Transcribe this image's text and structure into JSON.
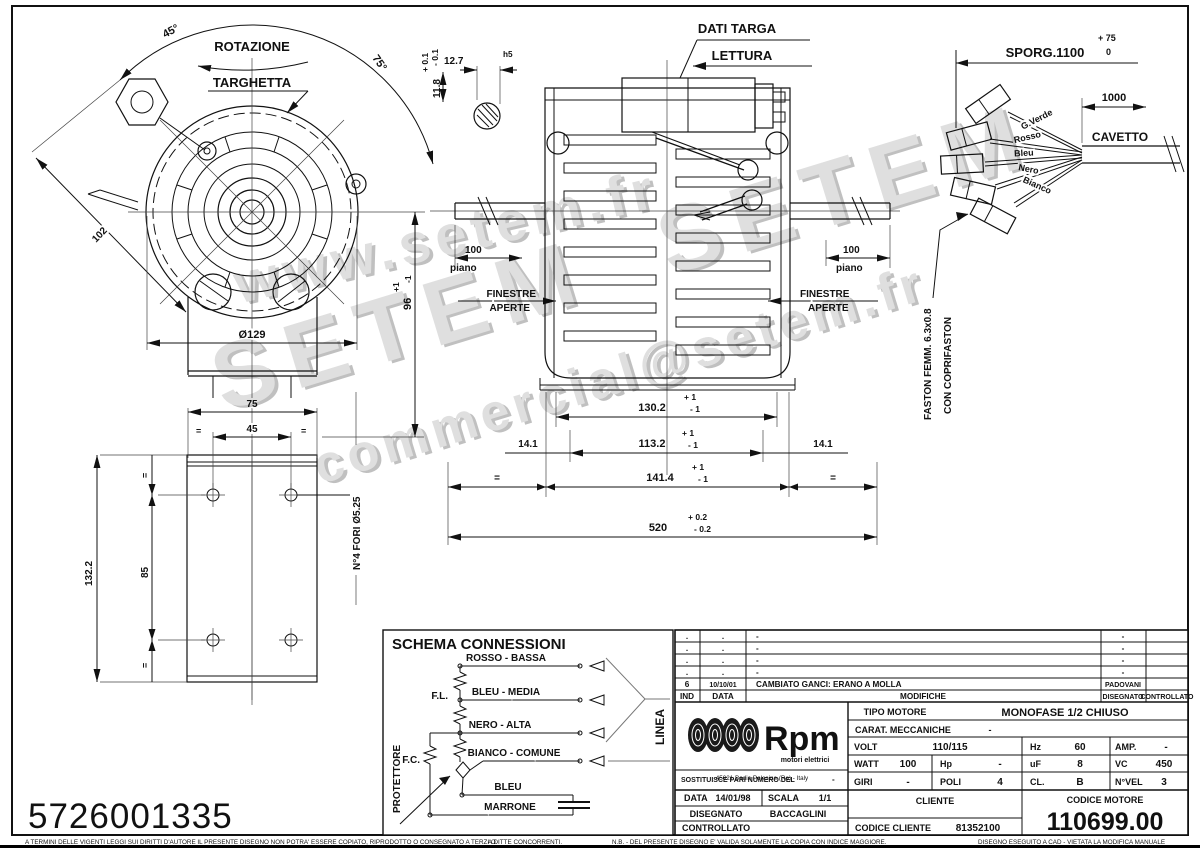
{
  "watermark": {
    "l1": "www.setem.fr",
    "l2": "SETEM  SETEM",
    "l3": "commercial@setem.fr"
  },
  "front": {
    "rotazione": "ROTAZIONE",
    "targhetta": "TARGHETTA",
    "a45": "45°",
    "a75": "75°",
    "d102": "102",
    "d129": "Ø129",
    "d96": "96",
    "tp1": "+1",
    "tm1": "-1",
    "d118": "11.8",
    "tp01": "+ 0.1",
    "tm01": "- 0.1",
    "d127": "12.7",
    "h5": "h5"
  },
  "side": {
    "dati_targa": "DATI TARGA",
    "lettura": "LETTURA",
    "finestre": "FINESTRE",
    "aperte": "APERTE",
    "d100": "100",
    "piano": "piano",
    "d1302": "130.2",
    "d1132": "113.2",
    "d1414": "141.4",
    "d520": "520",
    "tp1": "+ 1",
    "tm1": "- 1",
    "tp02": "+ 0.2",
    "tm02": "- 0.2",
    "d141": "14.1",
    "eq": "="
  },
  "cable": {
    "sporg": "SPORG.1100",
    "tp75": "+ 75",
    "t0": "0",
    "d1000": "1000",
    "cavetto": "CAVETTO",
    "w1": "G.Verde",
    "w2": "Rosso",
    "w3": "Bleu",
    "w4": "Nero",
    "w5": "Bianco",
    "faston1": "FASTON FEMM. 6.3x0.8",
    "faston2": "CON COPRIFASTON"
  },
  "plate": {
    "d75": "75",
    "d45": "45",
    "d1322": "132.2",
    "d85": "85",
    "fori": "N°4 FORI Ø5.25",
    "eq": "="
  },
  "schema": {
    "title": "SCHEMA CONNESSIONI",
    "w1": "ROSSO - BASSA",
    "w2": "BLEU - MEDIA",
    "w3": "NERO - ALTA",
    "w4": "BIANCO - COMUNE",
    "w5": "BLEU",
    "w6": "MARRONE",
    "fl": "F.L.",
    "fc": "F.C.",
    "protettore": "PROTETTORE",
    "linea": "LINEA"
  },
  "part_number": "5726001335",
  "tb": {
    "rev": {
      "dot": ".",
      "dash": "-",
      "ind": "6",
      "date": "10/10/01",
      "note": "CAMBIATO GANCI: ERANO A MOLLA",
      "name": "PADOVANI",
      "h_ind": "IND",
      "h_data": "DATA",
      "h_mod": "MODIFICHE",
      "h_dis": "DISEGNATO",
      "h_con": "CONTROLLATO"
    },
    "logo": {
      "brand": "Rpm",
      "sub": "motori elettrici",
      "addr": "45021 Badia Polesine (Ro) - Italy"
    },
    "tipo_l": "TIPO MOTORE",
    "tipo": "MONOFASE 1/2 CHIUSO",
    "carat_l": "CARAT. MECCANICHE",
    "carat": "-",
    "volt_l": "VOLT",
    "volt": "110/115",
    "hz_l": "Hz",
    "hz": "60",
    "amp_l": "AMP.",
    "amp": "-",
    "watt_l": "WATT",
    "watt": "100",
    "hp_l": "Hp",
    "hp": "-",
    "uf_l": "uF",
    "uf": "8",
    "vc_l": "VC",
    "vc": "450",
    "giri_l": "GIRI",
    "giri": "-",
    "poli_l": "POLI",
    "poli": "4",
    "cl_l": "CL.",
    "cl": "B",
    "nvel_l": "N°VEL",
    "nvel": "3",
    "sost_l": "SOSTITUISCE PARI NUMERO DEL",
    "sost": "-",
    "data_l": "DATA",
    "data": "14/01/98",
    "scala_l": "SCALA",
    "scala": "1/1",
    "dis_l": "DISEGNATO",
    "dis": "BACCAGLINI",
    "con_l": "CONTROLLATO",
    "cliente_l": "CLIENTE",
    "cod_cli_l": "CODICE CLIENTE",
    "cod_cli": "81352100",
    "cod_mot_l": "CODICE MOTORE",
    "cod_mot": "110699.00"
  },
  "footer": {
    "left": "A TERMINI DELLE VIGENTI LEGGI SUI DIRITTI D'AUTORE IL PRESENTE DISEGNO NON POTRA' ESSERE COPIATO, RIPRODOTTO O CONSEGNATO A TERZI O",
    "center": "A DITTE CONCORRENTI.",
    "right1": "N.B. - DEL PRESENTE DISEGNO E' VALIDA SOLAMENTE LA COPIA CON INDICE MAGGIORE.",
    "right2": "DISEGNO ESEGUITO A CAD - VIETATA LA MODIFICA MANUALE"
  }
}
